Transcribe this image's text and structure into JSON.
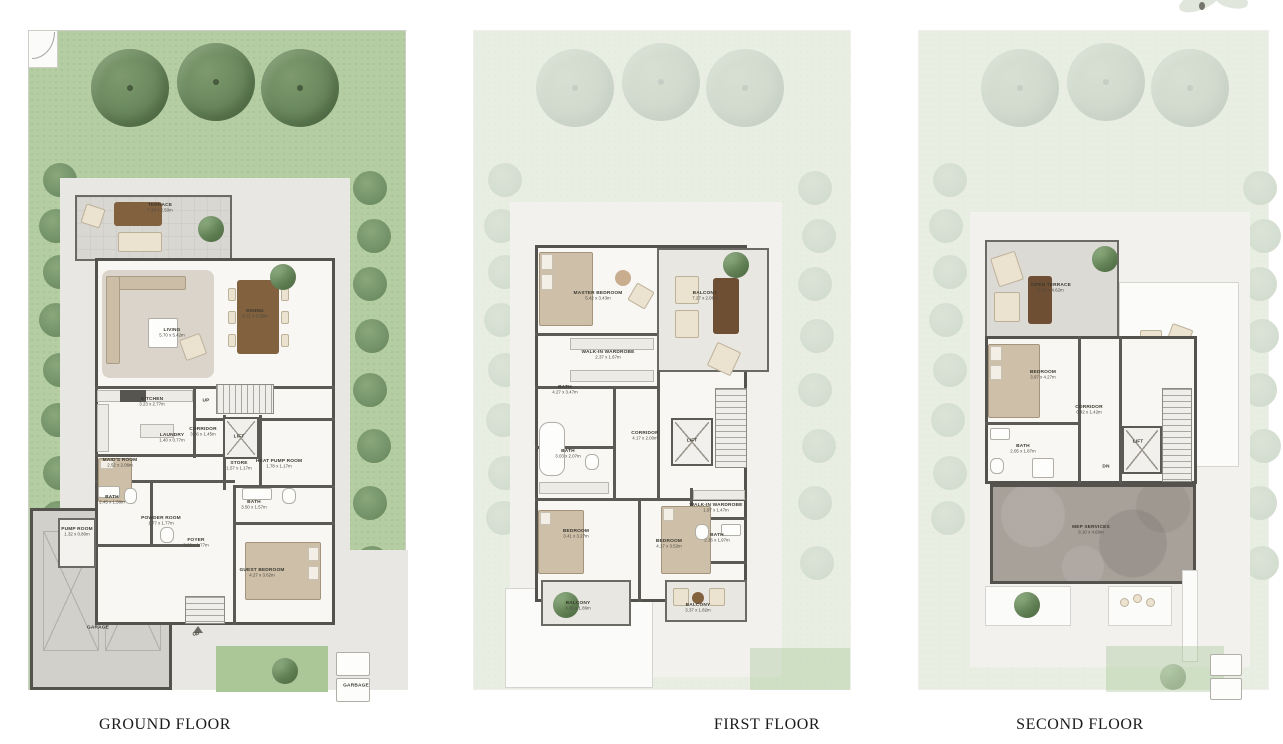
{
  "page": {
    "background": "#ffffff",
    "description": "Three-storey villa floor plan sheet"
  },
  "colors": {
    "garden_green": "#b5cda2",
    "tree_green": "#69875d",
    "wall_dark": "#53524c",
    "floor_light": "#f8f7f4",
    "terrace_gray": "#d9d7d2",
    "mep_gray": "#a8a19a",
    "furniture_tan": "#cebfa9",
    "table_brown": "#82613f",
    "caption_color": "#1b1b1b"
  },
  "floors": [
    {
      "caption": "GROUND FLOOR",
      "rooms": [
        {
          "label": "TERRACE",
          "dims": "7.10 x 2.50m",
          "x": 140,
          "y": 178
        },
        {
          "label": "LIVING",
          "dims": "5.70 x 5.42m",
          "x": 152,
          "y": 303
        },
        {
          "label": "DINING",
          "dims": "5.72 x 3.35m",
          "x": 235,
          "y": 284
        },
        {
          "label": "KITCHEN",
          "dims": "3.23 x 2.77m",
          "x": 132,
          "y": 372
        },
        {
          "label": "UP",
          "dims": "",
          "x": 186,
          "y": 371
        },
        {
          "label": "CORRIDOR",
          "dims": "3.86 x 1.45m",
          "x": 183,
          "y": 402
        },
        {
          "label": "LIFT",
          "dims": "",
          "x": 219,
          "y": 407
        },
        {
          "label": "LAUNDRY",
          "dims": "1.40 x 0.77m",
          "x": 152,
          "y": 408
        },
        {
          "label": "MAID'S ROOM",
          "dims": "2.52 x 2.06m",
          "x": 100,
          "y": 433
        },
        {
          "label": "STORE",
          "dims": "1.57 x 1.17m",
          "x": 219,
          "y": 436
        },
        {
          "label": "HEAT PUMP ROOM",
          "dims": "1.78 x 1.17m",
          "x": 259,
          "y": 434
        },
        {
          "label": "BATH",
          "dims": "2.45 x 1.58m",
          "x": 92,
          "y": 470
        },
        {
          "label": "POWDER ROOM",
          "dims": "1.77 x 1.77m",
          "x": 141,
          "y": 491
        },
        {
          "label": "PUMP ROOM",
          "dims": "1.32 x 0.80m",
          "x": 57,
          "y": 502
        },
        {
          "label": "FOYER",
          "dims": "3.66 x 1.77m",
          "x": 176,
          "y": 513
        },
        {
          "label": "BATH",
          "dims": "3.50 x 1.57m",
          "x": 234,
          "y": 475
        },
        {
          "label": "GUEST BEDROOM",
          "dims": "4.27 x 3.62m",
          "x": 242,
          "y": 543
        },
        {
          "label": "GARAGE",
          "dims": "",
          "x": 78,
          "y": 598
        },
        {
          "label": "UP",
          "dims": "",
          "x": 176,
          "y": 605
        },
        {
          "label": "GARBAGE",
          "dims": "",
          "x": 336,
          "y": 656
        }
      ]
    },
    {
      "caption": "FIRST FLOOR",
      "rooms": [
        {
          "label": "MASTER BEDROOM",
          "dims": "5.42 x 3.43m",
          "x": 133,
          "y": 266
        },
        {
          "label": "BALCONY",
          "dims": "7.27 x 2.06m",
          "x": 240,
          "y": 266
        },
        {
          "label": "WALK-IN WARDROBE",
          "dims": "2.37 x 1.67m",
          "x": 143,
          "y": 325
        },
        {
          "label": "BATH",
          "dims": "4.27 x 3.47m",
          "x": 100,
          "y": 360
        },
        {
          "label": "CORRIDOR",
          "dims": "4.17 x 2.00m",
          "x": 180,
          "y": 406
        },
        {
          "label": "LIFT",
          "dims": "",
          "x": 227,
          "y": 411
        },
        {
          "label": "BATH",
          "dims": "3.03 x 2.07m",
          "x": 103,
          "y": 424
        },
        {
          "label": "BEDROOM",
          "dims": "3.41 x 3.27m",
          "x": 111,
          "y": 504
        },
        {
          "label": "BEDROOM",
          "dims": "4.17 x 3.52m",
          "x": 204,
          "y": 514
        },
        {
          "label": "WALK-IN WARDROBE",
          "dims": "1.97 x 1.47m",
          "x": 251,
          "y": 478
        },
        {
          "label": "BATH",
          "dims": "2.36 x 1.97m",
          "x": 252,
          "y": 508
        },
        {
          "label": "BALCONY",
          "dims": "3.65 x 1.86m",
          "x": 113,
          "y": 576
        },
        {
          "label": "BALCONY",
          "dims": "3.37 x 1.82m",
          "x": 233,
          "y": 578
        }
      ]
    },
    {
      "caption": "SECOND FLOOR",
      "rooms": [
        {
          "label": "OPEN TERRACE",
          "dims": "5.82 x 4.62m",
          "x": 141,
          "y": 258
        },
        {
          "label": "BEDROOM",
          "dims": "3.97 x 4.27m",
          "x": 133,
          "y": 345
        },
        {
          "label": "CORRIDOR",
          "dims": "6.42 x 1.42m",
          "x": 179,
          "y": 380
        },
        {
          "label": "LIFT",
          "dims": "",
          "x": 228,
          "y": 412
        },
        {
          "label": "BATH",
          "dims": "2.05 x 1.87m",
          "x": 113,
          "y": 419
        },
        {
          "label": "DN",
          "dims": "",
          "x": 196,
          "y": 437
        },
        {
          "label": "MEP SERVICES",
          "dims": "9.10 x 4.60m",
          "x": 181,
          "y": 500
        }
      ]
    }
  ]
}
